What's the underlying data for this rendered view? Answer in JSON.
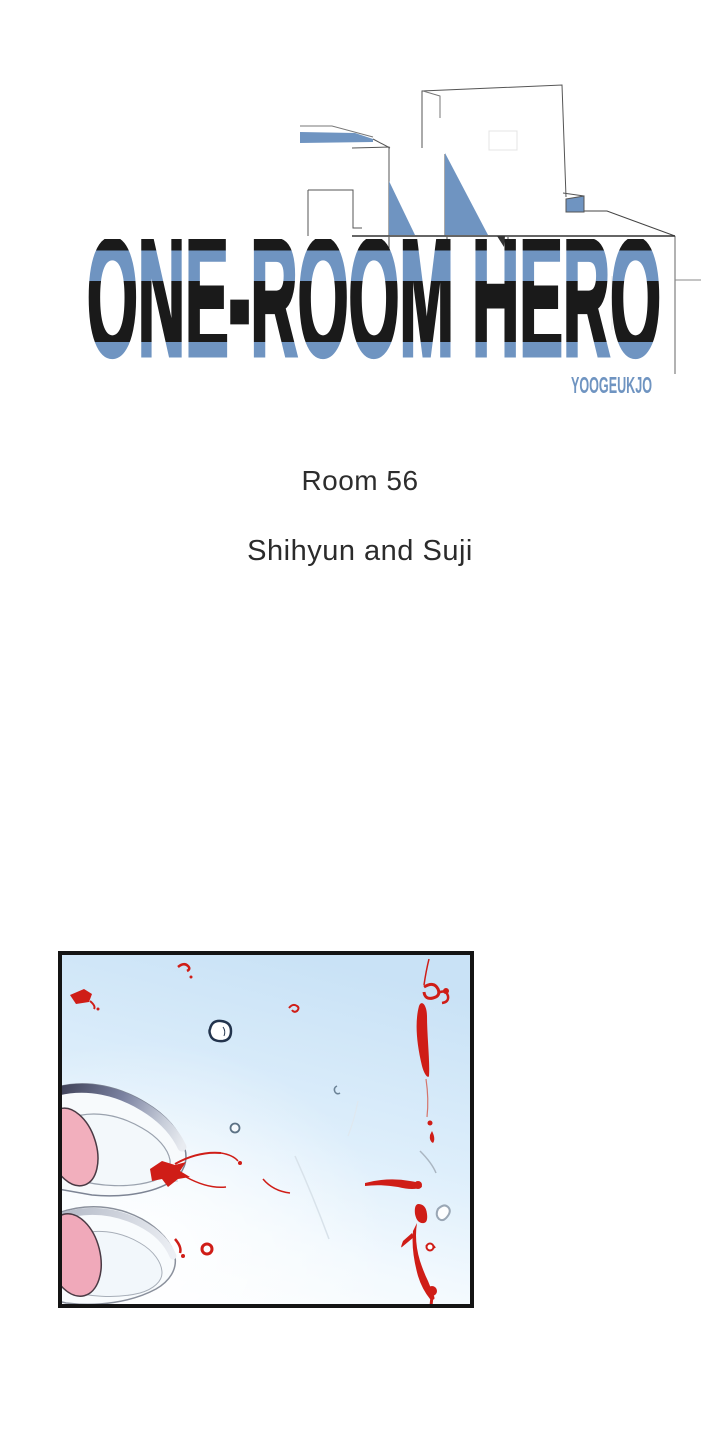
{
  "header": {
    "series_title": "ONE-ROOM HERO",
    "author": "YOOGEUKJO"
  },
  "episode": {
    "room_label": "Room 56",
    "subtitle": "Shihyun and Suji"
  },
  "colors": {
    "accent_blue": "#6f94c1",
    "title_ink": "#1a1a1a",
    "text_ink": "#2d2d2d",
    "line_art_gray": "#555555",
    "blood_red": "#cf1d17",
    "sky_blue": "#c9e2f6",
    "shoe_pink": "#f2afbd",
    "panel_border": "#141414",
    "page_background": "#ffffff"
  }
}
